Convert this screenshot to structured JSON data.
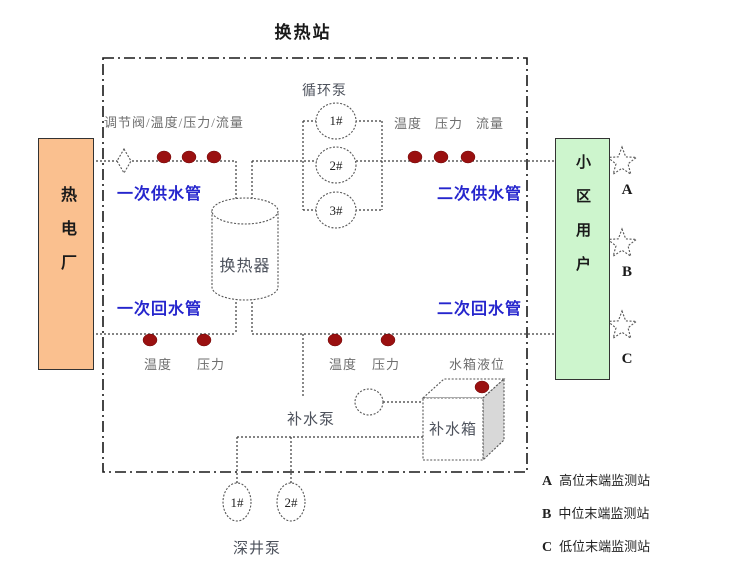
{
  "title": "换热站",
  "plant": {
    "label": "热电厂"
  },
  "users": {
    "label": "小区用户"
  },
  "pipes": {
    "supply1": "一次供水管",
    "supply2": "二次供水管",
    "return1": "一次回水管",
    "return2": "二次回水管"
  },
  "equipment": {
    "exchanger": "换热器",
    "circulation_pump": "循环泵",
    "circulation_units": [
      "1#",
      "2#",
      "3#"
    ],
    "makeup_pump": "补水泵",
    "makeup_tank": "补水箱",
    "deep_well_pump": "深井泵",
    "deep_well_units": [
      "1#",
      "2#"
    ]
  },
  "sensors": {
    "top_left": "调节阀/温度/压力/流量",
    "top_right": [
      "温度",
      "压力",
      "流量"
    ],
    "bottom_left": [
      "温度",
      "压力"
    ],
    "bottom_right": [
      "温度",
      "压力"
    ],
    "tank_level": "水箱液位"
  },
  "stars": [
    {
      "id": "A"
    },
    {
      "id": "B"
    },
    {
      "id": "C"
    }
  ],
  "legend": [
    {
      "key": "A",
      "text": "高位末端监测站"
    },
    {
      "key": "B",
      "text": "中位末端监测站"
    },
    {
      "key": "C",
      "text": "低位末端监测站"
    }
  ],
  "colors": {
    "pipe-label-blue": "#2525cd",
    "sensor-dot-red": "#9a1010",
    "plant-fill": "#fac08f",
    "users-fill": "#cdf5cd",
    "sensor-gray": "#6e6e6e",
    "equip-gray": "#4d525c"
  }
}
